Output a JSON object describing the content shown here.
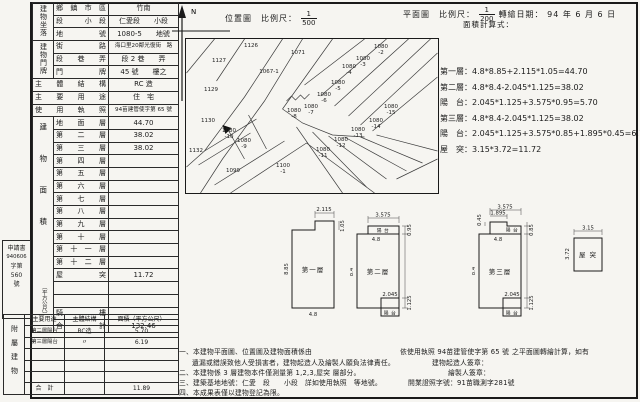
{
  "stamp": {
    "line1": "申請書",
    "line2": "940606",
    "line3": "字第",
    "line4": "560",
    "line5": "號"
  },
  "building_table": {
    "groups": [
      "建物坐落",
      "建物門牌"
    ],
    "rows": [
      {
        "label": "鄉鎮市區",
        "value": "竹南"
      },
      {
        "label": "段　小段",
        "value": "仁愛段　　小段"
      },
      {
        "label": "地　號",
        "value": "1080-5　　地號"
      },
      {
        "label": "街　路",
        "value": "海口里20鄰光復街　路"
      },
      {
        "label": "段　巷　弄",
        "value": "段 2 巷　　弄"
      },
      {
        "label": "門　牌",
        "value": "45 號　　樓之"
      },
      {
        "label": "主體結構",
        "value": "RC 造"
      },
      {
        "label": "主要用途",
        "value": "住　宅"
      },
      {
        "label": "使用執照",
        "value": "94苗建管使字第 65 號"
      }
    ],
    "area_group": "建物面積",
    "area_unit": "（平方公尺）",
    "area_rows": [
      {
        "label": "地　面　層",
        "value": "44.70"
      },
      {
        "label": "第　二　層",
        "value": "38.02"
      },
      {
        "label": "第　三　層",
        "value": "38.02"
      },
      {
        "label": "第　四　層",
        "value": ""
      },
      {
        "label": "第　五　層",
        "value": ""
      },
      {
        "label": "第　六　層",
        "value": ""
      },
      {
        "label": "第　七　層",
        "value": ""
      },
      {
        "label": "第　八　層",
        "value": ""
      },
      {
        "label": "第　九　層",
        "value": ""
      },
      {
        "label": "第　十　層",
        "value": ""
      },
      {
        "label": "第十一層",
        "value": ""
      },
      {
        "label": "第十二層",
        "value": ""
      },
      {
        "label": "屋　突",
        "value": "11.72"
      },
      {
        "label": "",
        "value": ""
      },
      {
        "label": "",
        "value": ""
      },
      {
        "label": "騎　樓",
        "value": ""
      },
      {
        "label": "合　計",
        "value": "132.46"
      }
    ]
  },
  "attach_table": {
    "side": "附屬建物",
    "headers": {
      "use": "主要用途",
      "structure": "主體結構",
      "area": "面積（平方公尺）"
    },
    "rows": [
      {
        "use": "第二層陽台",
        "structure": "RC造",
        "area": "5.70"
      },
      {
        "use": "第三層陽台",
        "structure": "〃",
        "area": "6.19"
      },
      {
        "use": "",
        "structure": "",
        "area": ""
      },
      {
        "use": "",
        "structure": "",
        "area": ""
      },
      {
        "use": "",
        "structure": "",
        "area": ""
      }
    ],
    "total_label": "合　計",
    "total": "11.89"
  },
  "site_plan": {
    "title": "位置圖",
    "scale_label": "比例尺：",
    "scale_num": "1",
    "scale_den": "500",
    "north": "N",
    "parcels": [
      "1126",
      "1127",
      "1071",
      "1067-1",
      "1129",
      "1080 -2",
      "1080 -3",
      "1080 -4",
      "1080 -5",
      "1080 -6",
      "1080 -7",
      "1080 -8",
      "1080 -15",
      "1130",
      "1080 -10",
      "1080 -9",
      "1132",
      "1080 -11",
      "1080 -12",
      "1080 -13",
      "1080 -14",
      "1099",
      "1100 -1"
    ]
  },
  "plan_header": {
    "title": "平面圖",
    "scale_label": "比例尺：",
    "scale_num": "1",
    "scale_den": "200",
    "date_label": "轉繪日期：",
    "date": "94 年 6 月 6 日",
    "calc_label": "面積計算式："
  },
  "formulas": [
    {
      "text": "第一層：4.8*8.85+2.115*1.05=44.70"
    },
    {
      "text": "第二層：4.8*8.4-2.045*1.125=38.02"
    },
    {
      "text": "陽　台：2.045*1.125+3.575*0.95=5.70"
    },
    {
      "text": "第三層：4.8*8.4-2.045*1.125=38.02"
    },
    {
      "text": "陽　台：2.045*1.125+3.575*0.85+1.895*0.45=6.19"
    },
    {
      "text": "屋　突：3.15*3.72=11.72"
    }
  ],
  "plans": {
    "p1": {
      "name": "第一層",
      "w": "4.8",
      "h": "8.85",
      "top": "2.115",
      "right": "1.05"
    },
    "p2": {
      "name": "第二層",
      "top": "3.575",
      "w": "4.8",
      "h": "8.4",
      "d1": "0.95",
      "d2": "1.125",
      "bw": "2.045",
      "balcony_top": "陽 台",
      "balcony_bottom": "陽 台"
    },
    "p3": {
      "name": "第三層",
      "top": "3.575",
      "top2": "1.895",
      "left": "0.45",
      "w": "4.8",
      "h": "8.4",
      "d1": "0.85",
      "d2": "1.125",
      "bw": "2.045",
      "balcony_top": "陽 台",
      "balcony_bottom": "陽 台"
    },
    "roof": {
      "name": "屋 突",
      "w": "3.15",
      "h": "3.72"
    }
  },
  "notes": {
    "l1": "一、本建物平面圖、位置圖及建物面積係由",
    "l1b": "依使用執照 94苗建管使字第 65 號",
    "l1c": "之平面圖轉繪計算，如有",
    "l2": "遺漏或錯誤致他人受損害者，建物起造人及繪製人願負法律責任。",
    "l3": "二、本建物係 3 層建物本件僅測量第 1,2,3,屋突 層部分。",
    "l4": "三、建築基地地號：仁愛　段　　小段　詳如使用執照　等地號。",
    "l5": "四、本成果表僅以建物登記為限。",
    "sig1": "建物起造人簽章：",
    "sig2": "繪製人簽章：",
    "lic": "開業證照字號：91苗職測字281號"
  }
}
